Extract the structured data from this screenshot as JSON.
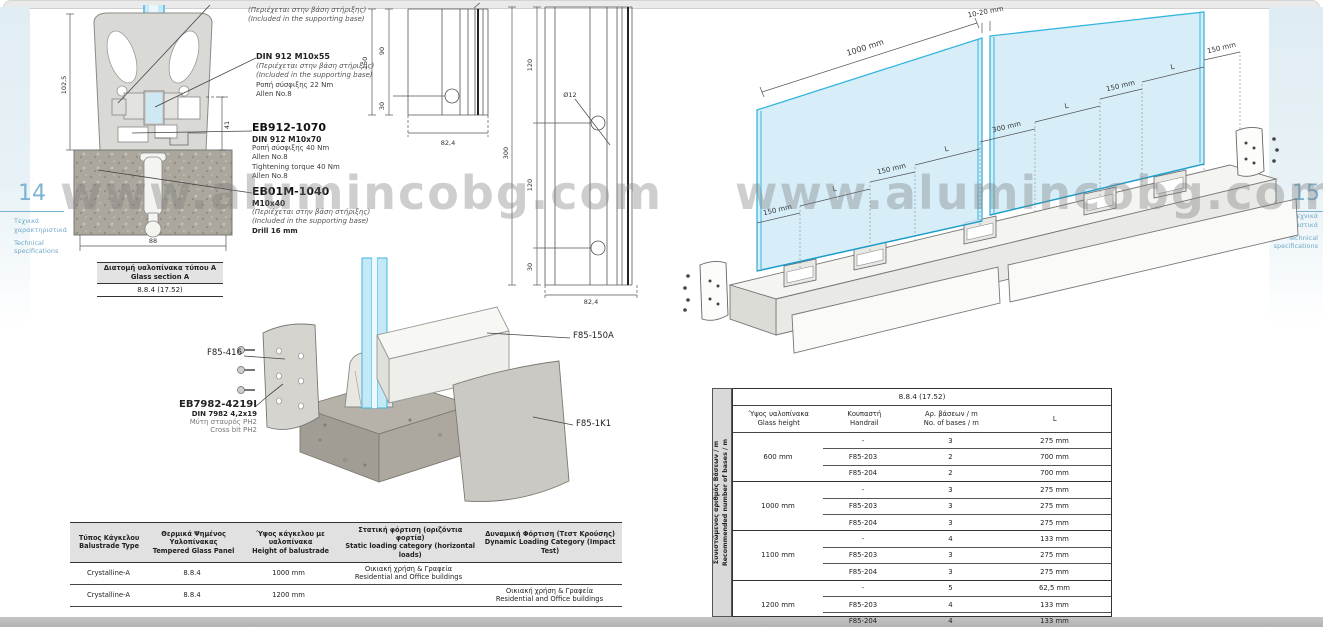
{
  "watermark": {
    "text": "www.alumincobg.com"
  },
  "left_page": {
    "page_number": "14",
    "margin": {
      "gr1": "Τεχνικά",
      "gr2": "χαρακτηριστικά",
      "en1": "Technical",
      "en2": "specifications"
    },
    "callout_top": {
      "gr": "(Περιέχεται στην βάση στήριξης)",
      "en": "(Included in the supporting base)"
    },
    "callout_din912": {
      "title": "DIN 912 M10x55",
      "gr": "(Περιέχεται στην βάση στήριξης)",
      "en": "(Included in the supporting base)",
      "torque": "Ροπή σύσφιξης 22 Nm",
      "allen": "Allen No.8"
    },
    "callout_eb912": {
      "code": "EB912-1070",
      "spec": "DIN 912 M10x70",
      "torque_gr": "Ροπή σύσφιξης 40 Nm",
      "allen1": "Allen No.8",
      "torque_en": "Tightening torque 40 Nm",
      "allen2": "Allen No.8"
    },
    "callout_eb01m": {
      "code": "EB01M-1040",
      "spec": "M10x40",
      "gr": "(Περιέχεται στην βάση στήριξης)",
      "en": "(Included in the supporting base)",
      "drill": "Drill 16 mm"
    },
    "cross_section": {
      "dim_height": "102,5",
      "dim_inner": "41",
      "dim_width": "88"
    },
    "front_view_small": {
      "dim_total": "150",
      "dim_top": "90",
      "dim_bottom": "30",
      "dim_width": "82,4"
    },
    "front_view_large": {
      "dim_total": "300",
      "dim_seg_top": "120",
      "dim_seg_mid": "120",
      "dim_seg_bottom": "30",
      "dim_hole": "Ø12",
      "dim_width": "82,4"
    },
    "glass_section_box": {
      "title_gr": "Διατομή υαλοπίνακα τύπου A",
      "title_en": "Glass section A",
      "value": "8.8.4 (17.52)"
    },
    "exploded": {
      "label_f85_416": "F85-416",
      "label_eb7982": "EB7982-4219I",
      "eb7982_spec": "DIN 7982 4,2x19",
      "eb7982_gr": "Μύτη σταυρός PH2",
      "eb7982_en": "Cross bit PH2",
      "label_f85_150a": "F85-150A",
      "label_f85_1k1": "F85-1K1"
    },
    "load_table": {
      "headers": [
        {
          "gr": "Τύπος Κάγκελου",
          "en": "Balustrade Type"
        },
        {
          "gr": "Θερμικά Ψημένος Υαλοπίνακας",
          "en": "Tempered Glass Panel"
        },
        {
          "gr": "Ύψος κάγκελου με υαλοπίνακα",
          "en": "Height of balustrade"
        },
        {
          "gr": "Στατική φόρτιση (οριζόντια φορτία)",
          "en": "Static loading category (horizontal loads)"
        },
        {
          "gr": "Δυναμική Φόρτιση (Τεστ Κρούσης)",
          "en": "Dynamic Loading Category (Impact Test)"
        }
      ],
      "rows": [
        {
          "type": "Crystalline-A",
          "glass": "8.8.4",
          "height": "1000 mm",
          "static_gr": "Οικιακή χρήση & Γραφεία",
          "static_en": "Residential and Office buildings",
          "dynamic_gr": "",
          "dynamic_en": ""
        },
        {
          "type": "Crystalline-A",
          "glass": "8.8.4",
          "height": "1200 mm",
          "static_gr": "",
          "static_en": "",
          "dynamic_gr": "Οικιακή χρήση & Γραφεία",
          "dynamic_en": "Residential and Office buildings"
        }
      ]
    }
  },
  "right_page": {
    "page_number": "15",
    "margin": {
      "gr1": "Τεχνικά",
      "gr2": "χαρακτηριστικά",
      "en1": "Technical",
      "en2": "specifications"
    },
    "perspective": {
      "dim_glass_width": "1000 mm",
      "dim_gap": "10-20 mm",
      "ladder": [
        "150 mm",
        "L",
        "150 mm",
        "L",
        "300 mm",
        "L",
        "150 mm",
        "L",
        "150 mm"
      ]
    },
    "bases_table": {
      "title": "8.8.4 (17.52)",
      "side_label_gr": "Συνιστώμενος αριθμός Βάσεων / m",
      "side_label_en": "Recommended number of bases / m",
      "headers": [
        {
          "gr": "Ύψος υαλοπίνακα",
          "en": "Glass height"
        },
        {
          "gr": "Κουπαστή",
          "en": "Handrail"
        },
        {
          "gr": "Αρ. βάσεων / m",
          "en": "No. of bases / m"
        },
        {
          "gr": "L",
          "en": ""
        }
      ],
      "groups": [
        {
          "height": "600 mm",
          "rows": [
            [
              "-",
              "3",
              "275 mm"
            ],
            [
              "F85-203",
              "2",
              "700 mm"
            ],
            [
              "F85-204",
              "2",
              "700 mm"
            ]
          ]
        },
        {
          "height": "1000 mm",
          "rows": [
            [
              "-",
              "3",
              "275 mm"
            ],
            [
              "F85-203",
              "3",
              "275 mm"
            ],
            [
              "F85-204",
              "3",
              "275 mm"
            ]
          ]
        },
        {
          "height": "1100 mm",
          "rows": [
            [
              "-",
              "4",
              "133 mm"
            ],
            [
              "F85-203",
              "3",
              "275 mm"
            ],
            [
              "F85-204",
              "3",
              "275 mm"
            ]
          ]
        },
        {
          "height": "1200 mm",
          "rows": [
            [
              "-",
              "5",
              "62,5 mm"
            ],
            [
              "F85-203",
              "4",
              "133 mm"
            ],
            [
              "F85-204",
              "4",
              "133 mm"
            ]
          ]
        }
      ]
    }
  }
}
